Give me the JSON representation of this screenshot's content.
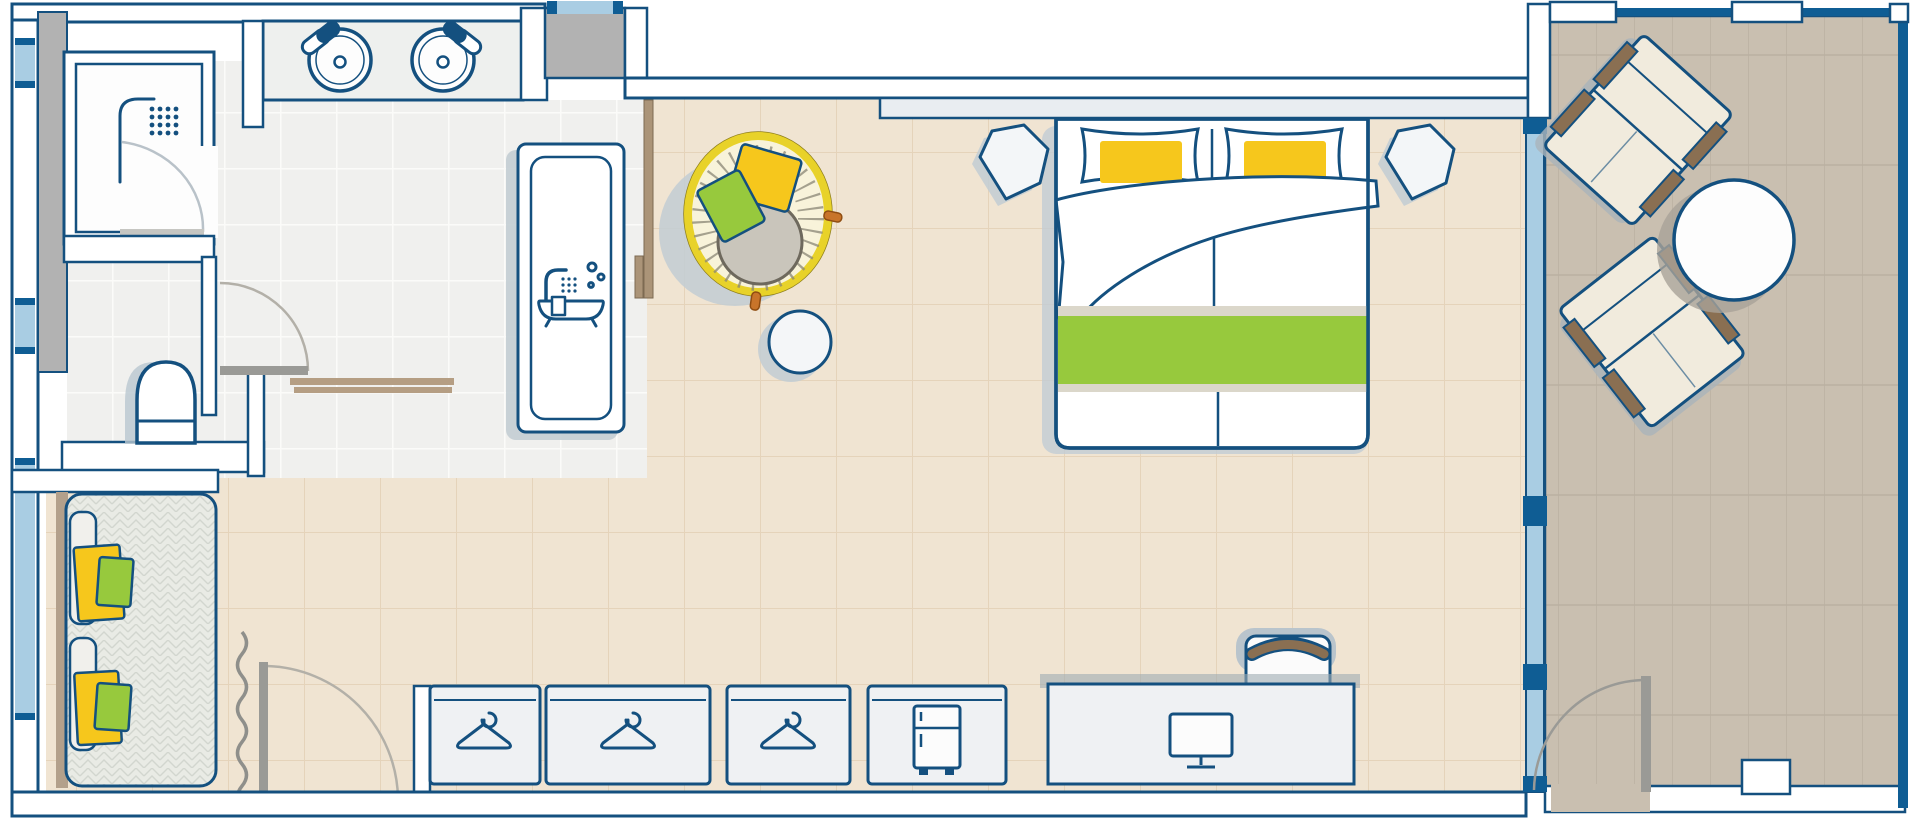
{
  "title": "hotel-guestroom-floor-plan",
  "colors": {
    "outline": "#14507f",
    "glass": "#a9cde3",
    "glassFrame": "#0f5d94",
    "wall": "#ffffff",
    "shaftGray": "#b2b2b2",
    "bathFloor": "#f0f0ee",
    "bedroomFloor": "#f0e4d2",
    "balconyFloor": "#c9bfb0",
    "accentYellow": "#f6c71c",
    "papasanRim": "#e8d229",
    "papasanCream": "#f8f3da",
    "seatGray": "#c9c5bb",
    "accentGreen": "#97c93d",
    "runnerEdge": "#dbd7ca",
    "wood": "#ab9478",
    "armBrown": "#8a6f52",
    "daybedTexture": "#e9ebe5",
    "doorGray": "#9a9a96",
    "cushionCream": "#f1ebdd"
  },
  "rooms": {
    "bathroom": {
      "name": "bathroom",
      "fixtures": [
        "shower",
        "double-sink-vanity",
        "bathtub",
        "toilet",
        "bath-mat",
        "shower-door",
        "bathroom-door"
      ]
    },
    "bedroom": {
      "name": "bedroom",
      "fixtures": [
        "double-bed",
        "pillow-left",
        "pillow-right",
        "duvet",
        "bed-runner",
        "nightstand-left",
        "nightstand-right",
        "papasan-chair",
        "side-table",
        "daybed",
        "curtain",
        "dressing-door",
        "wardrobe-1",
        "wardrobe-2",
        "wardrobe-3",
        "minibar",
        "desk",
        "desk-chair",
        "monitor"
      ]
    },
    "balcony": {
      "name": "balcony",
      "fixtures": [
        "lounge-chair-top",
        "lounge-chair-bottom",
        "round-table",
        "balcony-door",
        "glass-wall"
      ]
    }
  },
  "icons": [
    "shower-icon",
    "bathtub-icon",
    "sink-icon",
    "hanger-icon",
    "fridge-icon",
    "monitor-icon"
  ]
}
